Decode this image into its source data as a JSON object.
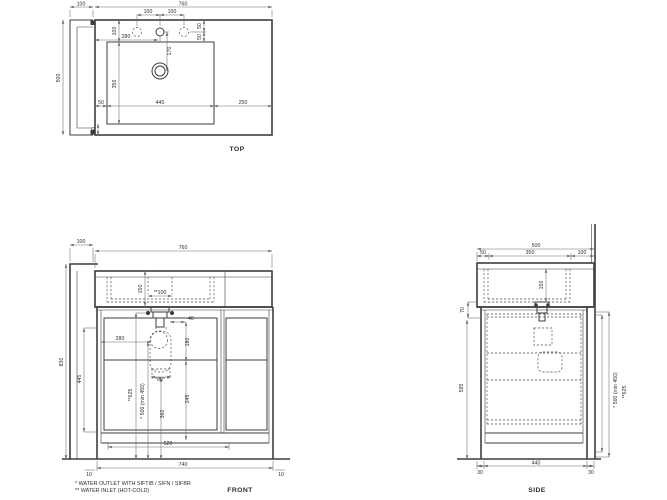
{
  "drawing": {
    "line_color": "#3d3d3d",
    "dim_line_color": "#6b6b6b",
    "text_color": "#2e2e2e",
    "background_color": "#ffffff"
  },
  "views": {
    "top": {
      "label": "TOP",
      "dims": {
        "panel_width": "100",
        "total_width": "760",
        "total_depth": "500",
        "hole_pitch_left": "100",
        "hole_pitch_right": "100",
        "hole_to_edge_a": "50",
        "hole_to_edge_b": "50",
        "deck_to_holes": "100",
        "holes_from_left": "280",
        "holes_to_drain": "170",
        "basin_depth": "350",
        "basin_gap_left": "50",
        "basin_width": "440",
        "deck_right": "250",
        "basin_gap_bottom": "50"
      }
    },
    "front": {
      "label": "FRONT",
      "dims": {
        "panel_width": "100",
        "top_width": "760",
        "basin_height": "150",
        "inlet_pitch": "**100",
        "drain_offset": "40",
        "trap_from_left": "280",
        "trap_height": "180",
        "trap_width": "80",
        "outlet_drop": "245",
        "drain_height": "360",
        "outlet_height": "* 500 (min 450)",
        "inlet_height": "**625",
        "interior_height": "445",
        "total_height": "830",
        "plinth_width": "520",
        "cabinet_width": "740",
        "foot_left": "10",
        "foot_right": "10"
      }
    },
    "side": {
      "label": "SIDE",
      "dims": {
        "total_depth": "500",
        "front_overhang": "50",
        "basin_span": "350",
        "back_span": "100",
        "basin_height": "150",
        "apron_gap": "70",
        "cabinet_height": "595",
        "outlet_height": "* 500 (min 450)",
        "inlet_height": "**625",
        "foot_front": "30",
        "base_depth": "440",
        "foot_back": "30"
      }
    }
  },
  "notes": {
    "outlet": "*  WATER OUTLET WITH SIFTIB / SIFN / SIFBR",
    "inlet": "** WATER INLET (HOT-COLD)"
  }
}
